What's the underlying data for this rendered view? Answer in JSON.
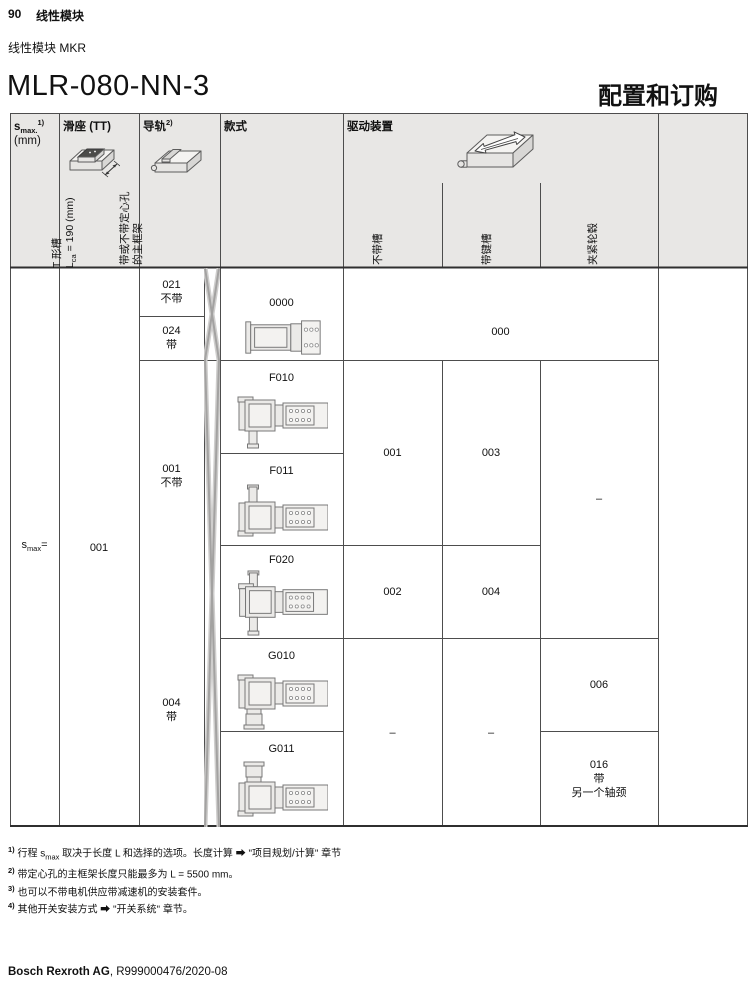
{
  "page": {
    "page_number": "90",
    "chapter_title": "线性模块",
    "product_line": "线性模块 MKR",
    "model_title": "MLR-080-NN-3",
    "section_title": "配置和订购",
    "footer_company": "Bosch Rexroth AG",
    "footer_document": ", R999000476/2020-08"
  },
  "colors": {
    "header_bg": "#e8e7e5",
    "grid_line": "#4d4d4d",
    "text": "#111111"
  },
  "table": {
    "header": {
      "smax_symbol": "s",
      "smax_subscript": "max.",
      "smax_footnote": "1)",
      "smax_unit": "(mm)",
      "carriage_title": "滑座 (TT)",
      "carriage_note_line1": "T 形槽",
      "carriage_note_l": "L",
      "carriage_note_l_sub": "ca",
      "carriage_note_l_rest": " = 190 (mm)",
      "rail_title": "导轨",
      "rail_footnote": "2)",
      "rail_note_line1": "带或不带定心孔",
      "rail_note_line2": "的主框架",
      "style_title": "款式",
      "drive_title": "驱动装置",
      "drive_sub_noslot": "不带槽",
      "drive_sub_keyway": "带键槽",
      "drive_sub_hub": "夹紧轮毂"
    },
    "body": {
      "smax_symbol": "s",
      "smax_subscript": "max",
      "smax_equals": "=",
      "carriage_code": "001",
      "rail_options": [
        {
          "code": "021",
          "label": "不带"
        },
        {
          "code": "024",
          "label": "带"
        },
        {
          "code": "001",
          "label": "不带"
        },
        {
          "code": "004",
          "label": "带"
        }
      ],
      "style_options": [
        {
          "code": "0000"
        },
        {
          "code": "F010"
        },
        {
          "code": "F011"
        },
        {
          "code": "F020"
        },
        {
          "code": "G010"
        },
        {
          "code": "G011"
        }
      ],
      "drive_codes": {
        "base": "000",
        "f_noslot": "001",
        "f_keyway": "003",
        "f_hub": "–",
        "f020_noslot": "002",
        "f020_keyway": "004",
        "g_noslot": "–",
        "g_keyway": "–",
        "g010_hub": "006",
        "g011_hub_code": "016",
        "g011_hub_line2": "带",
        "g011_hub_line3": "另一个轴颈"
      }
    }
  },
  "footnotes": [
    {
      "marker": "1)",
      "pre": "行程 s",
      "sub": "max",
      "post": " 取决于长度 L 和选择的选项。长度计算 ➡ \"项目规划/计算\" 章节"
    },
    {
      "marker": "2)",
      "text": "带定心孔的主框架长度只能最多为 L = 5500 mm。"
    },
    {
      "marker": "3)",
      "text": "也可以不带电机供应带减速机的安装套件。"
    },
    {
      "marker": "4)",
      "text": "其他开关安装方式 ➡ \"开关系统\" 章节。"
    }
  ]
}
